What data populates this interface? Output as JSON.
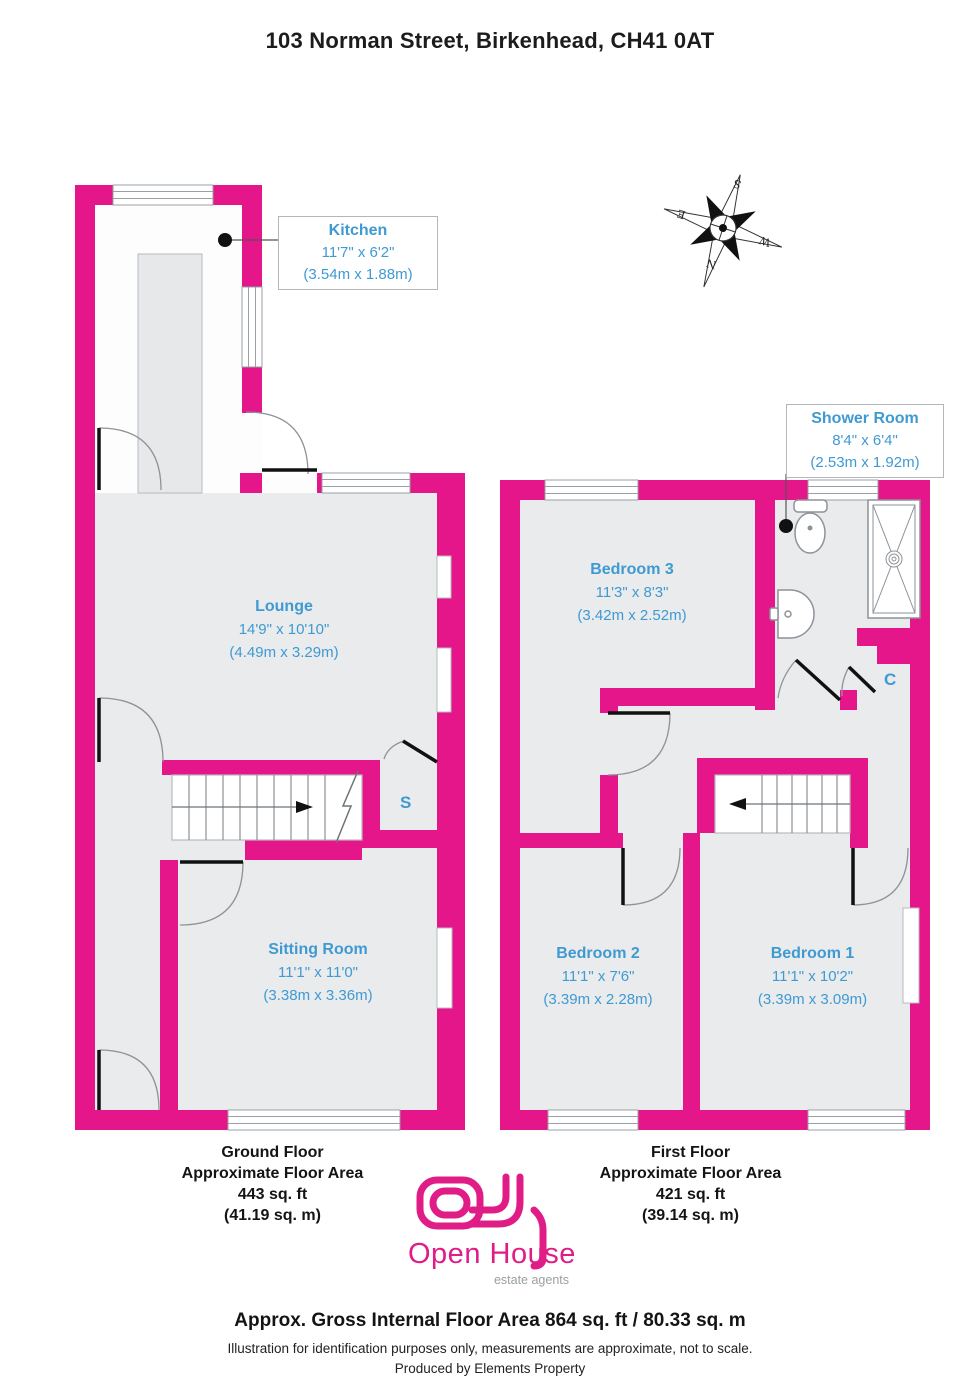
{
  "title": "103 Norman Street, Birkenhead, CH41 0AT",
  "rooms": {
    "kitchen": {
      "name": "Kitchen",
      "imperial": "11'7\" x 6'2\"",
      "metric": "(3.54m x 1.88m)"
    },
    "lounge": {
      "name": "Lounge",
      "imperial": "14'9\" x 10'10\"",
      "metric": "(4.49m x 3.29m)"
    },
    "sitting_room": {
      "name": "Sitting Room",
      "imperial": "11'1\" x 11'0\"",
      "metric": "(3.38m x 3.36m)"
    },
    "shower_room": {
      "name": "Shower Room",
      "imperial": "8'4\" x 6'4\"",
      "metric": "(2.53m x 1.92m)"
    },
    "bedroom3": {
      "name": "Bedroom 3",
      "imperial": "11'3\" x 8'3\"",
      "metric": "(3.42m x 2.52m)"
    },
    "bedroom2": {
      "name": "Bedroom 2",
      "imperial": "11'1\" x 7'6\"",
      "metric": "(3.39m x 2.28m)"
    },
    "bedroom1": {
      "name": "Bedroom 1",
      "imperial": "11'1\" x 10'2\"",
      "metric": "(3.39m x 3.09m)"
    }
  },
  "cupboards": {
    "stairs_cupboard": "S",
    "closet": "C"
  },
  "compass": {
    "n": "N",
    "s": "S",
    "e": "E",
    "w": "W"
  },
  "captions": {
    "ground": {
      "floor": "Ground Floor",
      "approx": "Approximate Floor Area",
      "area_ft": "443 sq. ft",
      "area_m": "(41.19 sq. m)"
    },
    "first": {
      "floor": "First Floor",
      "approx": "Approximate Floor Area",
      "area_ft": "421 sq. ft",
      "area_m": "(39.14 sq. m)"
    }
  },
  "logo": {
    "brand": "Open House",
    "tagline": "estate agents"
  },
  "footer": {
    "gross": "Approx. Gross Internal Floor Area 864 sq. ft / 80.33 sq. m",
    "disclaimer": "Illustration for identification purposes only, measurements are approximate, not to scale.",
    "produced": "Produced by Elements Property"
  },
  "colors": {
    "wall": "#e5158a",
    "room_fill": "#e9ebed",
    "label_blue": "#3f9ad2"
  }
}
